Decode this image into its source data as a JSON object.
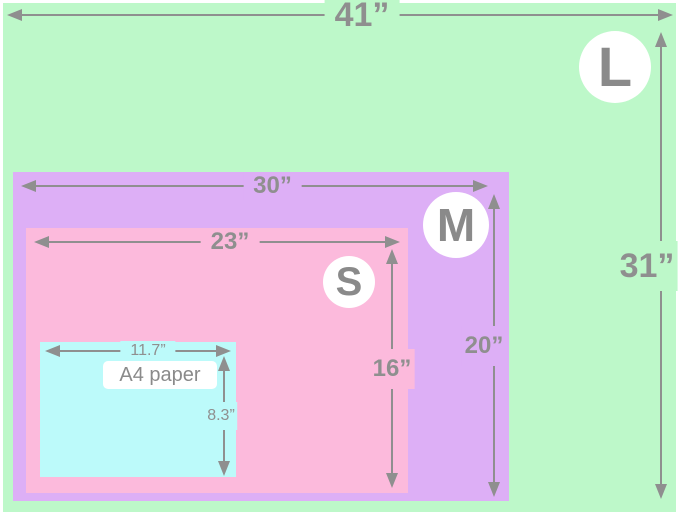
{
  "sizes": {
    "l": {
      "badge": "L",
      "width": "41”",
      "height": "31”"
    },
    "m": {
      "badge": "M",
      "width": "30”",
      "height": "20”"
    },
    "s": {
      "badge": "S",
      "width": "23”",
      "height": "16”"
    },
    "a4": {
      "label": "A4 paper",
      "width": "11.7”",
      "height": "8.3”"
    }
  },
  "colors": {
    "l_bg": "#bdf8c9",
    "m_bg": "#ddaff6",
    "s_bg": "#fcbadc",
    "a4_bg": "#bcfafa",
    "ink": "#8f8f8f",
    "badge_bg": "#ffffff",
    "frame_bg": "#ffffff"
  }
}
